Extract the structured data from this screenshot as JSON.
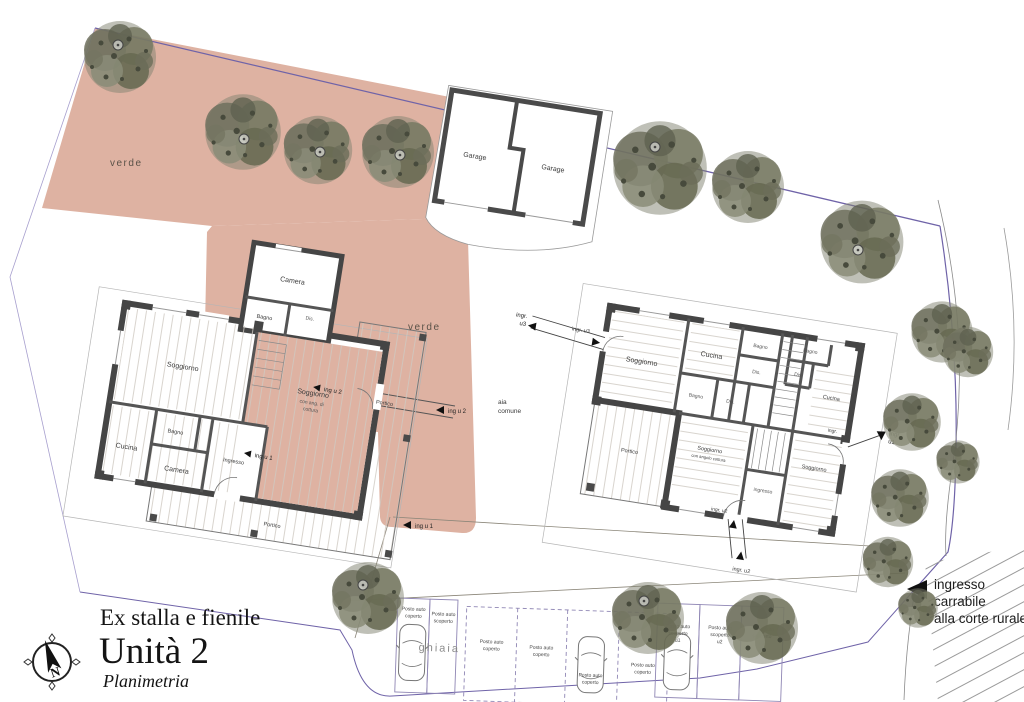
{
  "colors": {
    "zone_verde_fill": "#deb2a2",
    "wall": "#4a4a4a",
    "boundary": "#6f63a8",
    "tree": "#7f816f",
    "parking_line": "#8f86b4"
  },
  "site": {
    "verde_top": "verde",
    "verde_mid": "verde",
    "aia_1": "aia",
    "aia_2": "comune",
    "ghiaia": "ghiaia",
    "ingresso_note_1": "ingresso",
    "ingresso_note_2": "carrabile",
    "ingresso_note_3": "alla corte rurale"
  },
  "garage": {
    "left": "Garage",
    "right": "Garage"
  },
  "left_building": {
    "rooms": {
      "soggiorno": "Soggiorno",
      "cucina": "Cucina",
      "camera": "Camera",
      "bagno": "Bagno",
      "ingresso": "Ingresso",
      "camera_sup": "Camera",
      "bagno_sup": "Bagno",
      "dis": "Dis.",
      "sogg_ang_1": "Soggiorno",
      "sogg_ang_2": "con ang. di",
      "sogg_ang_3": "cottura",
      "portico_right": "Portico",
      "portico_bottom": "Portico"
    },
    "entrances": {
      "u1": "ing u 1",
      "u2": "ing u 2"
    }
  },
  "right_building": {
    "rooms": {
      "soggiorno_1": "Soggiorno",
      "cucina_1": "Cucina",
      "bagno_1": "Bagno",
      "dis_1": "Dis.",
      "bagno_2": "Bagno",
      "dis_2": "Dis.",
      "cucina_2": "Cucina",
      "bagno_3": "Bagno",
      "dis_3": "Dis.",
      "portico": "Portico",
      "sogg_ang_1": "Soggiorno",
      "sogg_ang_2": "con angolo cottura",
      "ingresso": "ingresso",
      "soggiorno_2": "Soggiorno"
    },
    "entrances": {
      "u3": "ingr. u3",
      "u3_l1": "ingr.",
      "u3_l2": "u3",
      "u2": "ingr. u2",
      "u1_near": "ingr.",
      "u1_l1": "ingr.",
      "u1_l2": "u1"
    }
  },
  "parking": {
    "posto_auto": "Posto auto",
    "coperto": "coperto",
    "scoperto": "scoperto",
    "u1": "u1",
    "u2": "u2",
    "u3": "u3"
  },
  "title_block": {
    "project": "Ex stalla e fienile",
    "unit": "Unità 2",
    "drawing": "Planimetria",
    "north": "N"
  }
}
